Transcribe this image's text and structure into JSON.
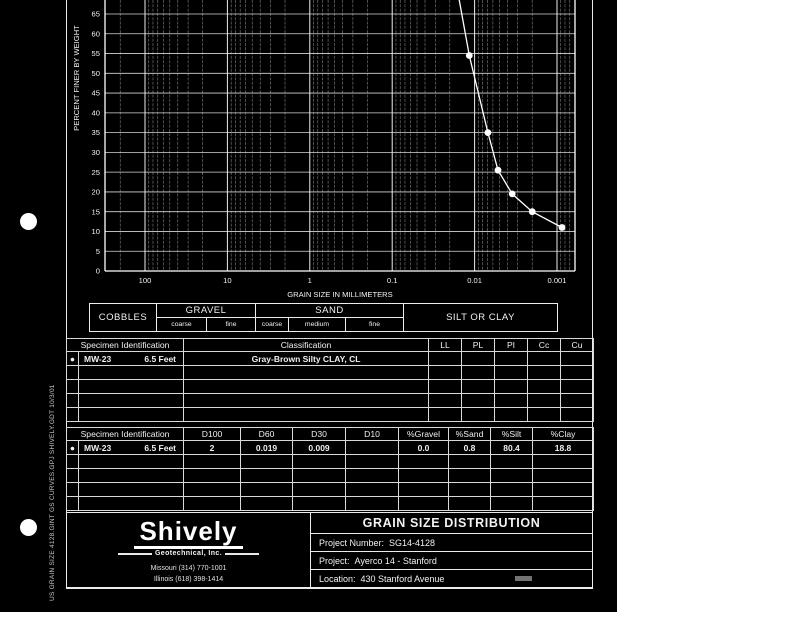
{
  "page": {
    "background_color": "#ffffff",
    "scan_background_color": "#000000",
    "ink_color": "#ffffff",
    "sidebar_filename": "US GRAIN SIZE  4128.GINT GS CURVES.GPJ  SHIVELY.GDT  10/3/01"
  },
  "chart_data": {
    "type": "line",
    "x_scale": "log",
    "xlabel": "GRAIN SIZE IN MILLIMETERS",
    "ylabel": "PERCENT FINER BY WEIGHT",
    "x_ticks": [
      100,
      10,
      1,
      0.1,
      0.01,
      0.001
    ],
    "y_ticks": [
      0,
      5,
      10,
      15,
      20,
      25,
      30,
      35,
      40,
      45,
      50,
      55,
      60,
      65
    ],
    "xlim": [
      300,
      0.0006
    ],
    "ylim_visible": [
      0,
      69
    ],
    "grid": true,
    "legend_position": "none",
    "series": [
      {
        "name": "MW-23  6.5 Feet",
        "marker": "filled-circle",
        "points_mm_percent": [
          [
            0.0155,
            69
          ],
          [
            0.0116,
            54.5
          ],
          [
            0.0069,
            35
          ],
          [
            0.0052,
            25.5
          ],
          [
            0.0035,
            19.5
          ],
          [
            0.002,
            15
          ],
          [
            0.00087,
            11
          ]
        ]
      }
    ]
  },
  "size_bands": {
    "cobbles": "COBBLES",
    "gravel": {
      "label": "GRAVEL",
      "subdivisions": [
        "coarse",
        "fine"
      ]
    },
    "sand": {
      "label": "SAND",
      "subdivisions": [
        "coarse",
        "medium",
        "fine"
      ]
    },
    "silt_or_clay": "SILT OR CLAY"
  },
  "classification_table": {
    "headers": {
      "specimen": "Specimen Identification",
      "classification": "Classification",
      "ll": "LL",
      "pl": "PL",
      "pi": "PI",
      "cc": "Cc",
      "cu": "Cu"
    },
    "row": {
      "marker": "●",
      "specimen_id": "MW-23",
      "depth": "6.5 Feet",
      "classification": "Gray-Brown Silty CLAY, CL",
      "ll": "",
      "pl": "",
      "pi": "",
      "cc": "",
      "cu": ""
    },
    "empty_row_count": 4
  },
  "gradation_table": {
    "headers": {
      "specimen": "Specimen Identification",
      "d100": "D100",
      "d60": "D60",
      "d30": "D30",
      "d10": "D10",
      "gravel": "%Gravel",
      "sand": "%Sand",
      "silt": "%Silt",
      "clay": "%Clay"
    },
    "row": {
      "marker": "●",
      "specimen_id": "MW-23",
      "depth": "6.5 Feet",
      "d100": "2",
      "d60": "0.019",
      "d30": "0.009",
      "d10": "",
      "gravel": "0.0",
      "sand": "0.8",
      "silt": "80.4",
      "clay": "18.8"
    },
    "empty_row_count": 4
  },
  "footer": {
    "logo_name": "Shively",
    "logo_tagline": "Geotechnical, Inc.",
    "phone_missouri": "Missouri (314) 770-1001",
    "phone_illinois": "Illinois (618) 398-1414",
    "report_title": "GRAIN SIZE DISTRIBUTION",
    "project_number_label": "Project Number:",
    "project_number_value": "SG14-4128",
    "project_label": "Project:",
    "project_value": "Ayerco 14 - Stanford",
    "location_label": "Location:",
    "location_value": "430 Stanford Avenue"
  }
}
